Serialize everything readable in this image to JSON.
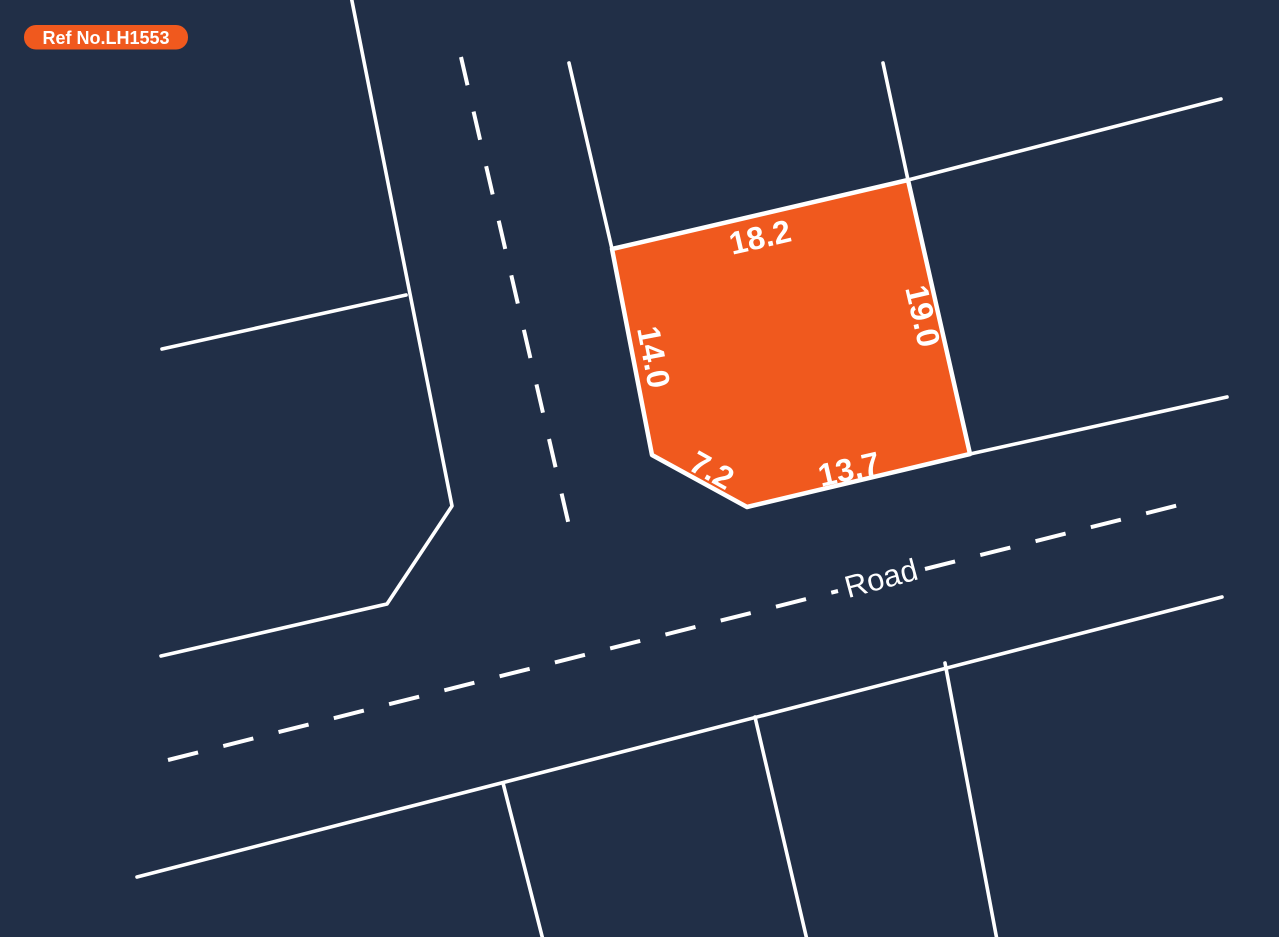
{
  "badge": {
    "label": "Ref No.LH1553"
  },
  "plot": {
    "dimensions": {
      "top": "18.2",
      "right": "19.0",
      "left": "14.0",
      "bottom_left": "7.2",
      "bottom": "13.7"
    }
  },
  "road": {
    "label": "Road"
  },
  "colors": {
    "background": "#212F47",
    "plot_fill": "#F0591E",
    "badge_fill": "#F0591E",
    "line": "#FFFFFF",
    "text": "#FFFFFF"
  }
}
